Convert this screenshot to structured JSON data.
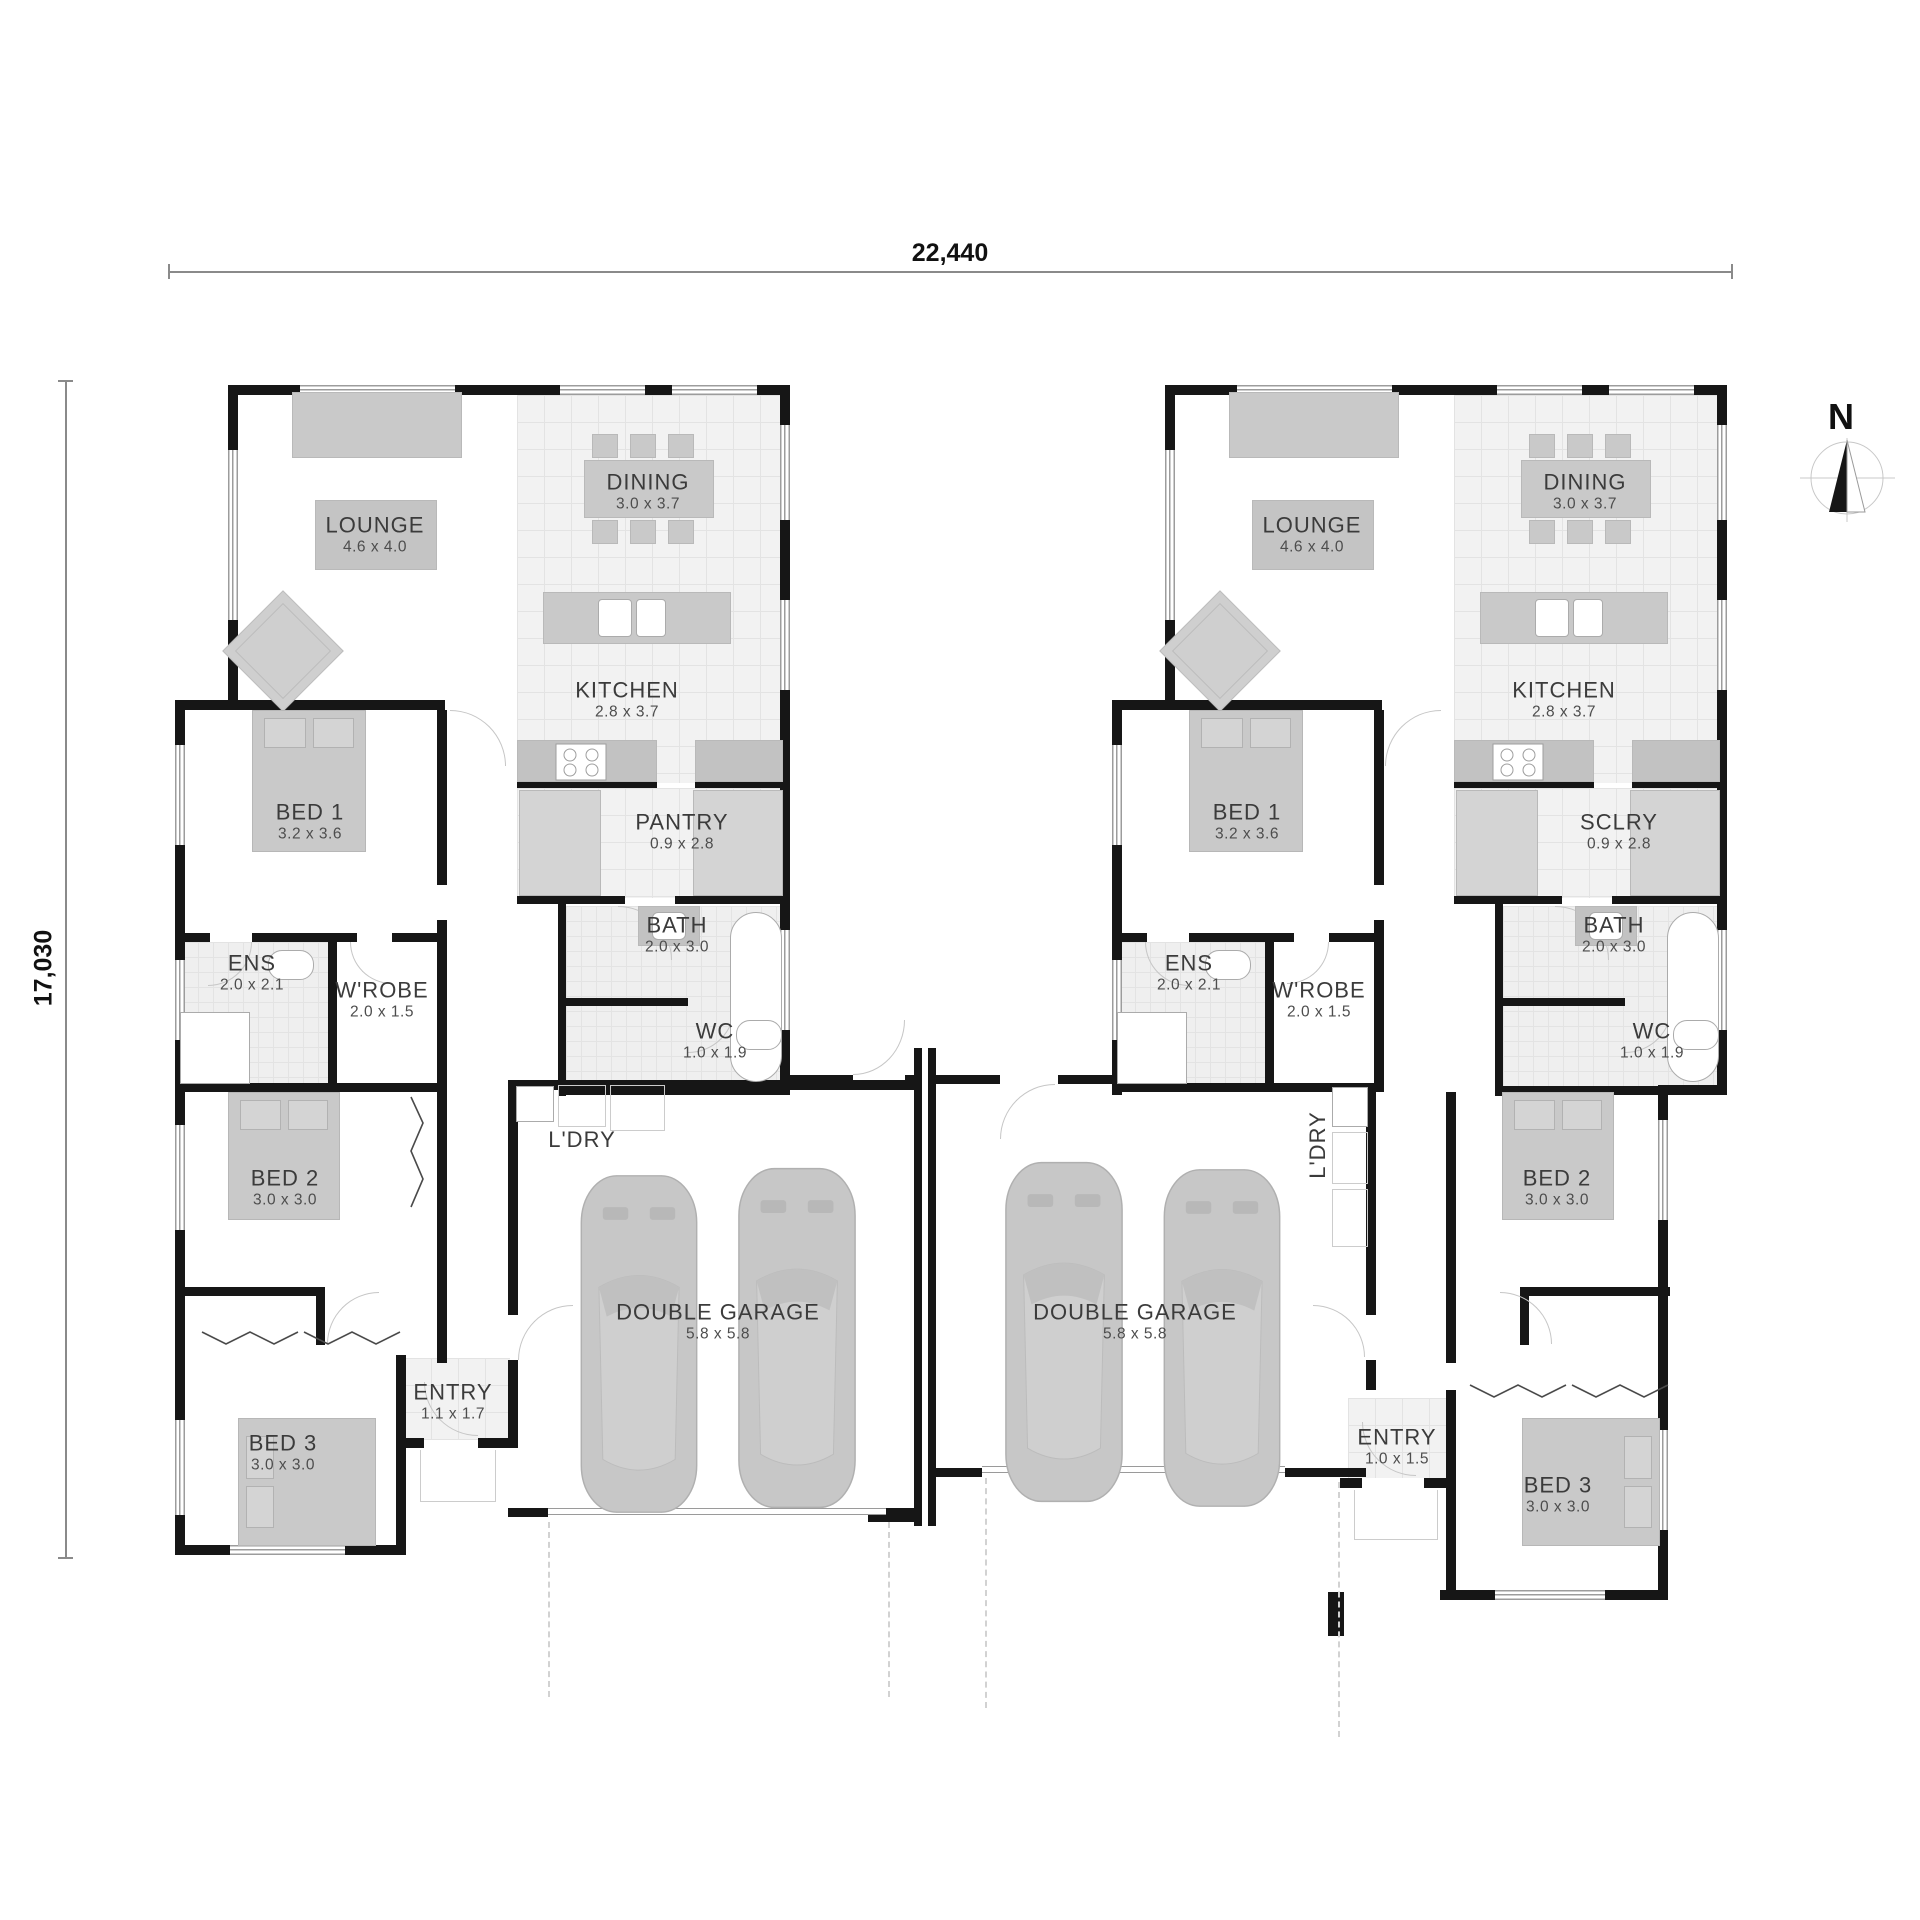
{
  "dimensions": {
    "width_label": "22,440",
    "height_label": "17,030"
  },
  "compass": {
    "label": "N"
  },
  "units": {
    "left": {
      "lounge": {
        "name": "LOUNGE",
        "size": "4.6 x 4.0"
      },
      "dining": {
        "name": "DINING",
        "size": "3.0 x 3.7"
      },
      "kitchen": {
        "name": "KITCHEN",
        "size": "2.8 x 3.7"
      },
      "bed1": {
        "name": "BED 1",
        "size": "3.2 x 3.6"
      },
      "pantry": {
        "name": "PANTRY",
        "size": "0.9 x 2.8"
      },
      "bath": {
        "name": "BATH",
        "size": "2.0 x 3.0"
      },
      "ens": {
        "name": "ENS",
        "size": "2.0 x 2.1"
      },
      "wrobe": {
        "name": "W'ROBE",
        "size": "2.0 x 1.5"
      },
      "wc": {
        "name": "WC",
        "size": "1.0 x 1.9"
      },
      "bed2": {
        "name": "BED 2",
        "size": "3.0 x 3.0"
      },
      "ldry": {
        "name": "L'DRY"
      },
      "garage": {
        "name": "DOUBLE GARAGE",
        "size": "5.8 x 5.8"
      },
      "entry": {
        "name": "ENTRY",
        "size": "1.1 x 1.7"
      },
      "bed3": {
        "name": "BED 3",
        "size": "3.0 x 3.0"
      }
    },
    "right": {
      "lounge": {
        "name": "LOUNGE",
        "size": "4.6 x 4.0"
      },
      "dining": {
        "name": "DINING",
        "size": "3.0 x 3.7"
      },
      "kitchen": {
        "name": "KITCHEN",
        "size": "2.8 x 3.7"
      },
      "bed1": {
        "name": "BED 1",
        "size": "3.2 x 3.6"
      },
      "sclry": {
        "name": "SCLRY",
        "size": "0.9 x 2.8"
      },
      "bath": {
        "name": "BATH",
        "size": "2.0 x 3.0"
      },
      "ens": {
        "name": "ENS",
        "size": "2.0 x 2.1"
      },
      "wrobe": {
        "name": "W'ROBE",
        "size": "2.0 x 1.5"
      },
      "wc": {
        "name": "WC",
        "size": "1.0 x 1.9"
      },
      "bed2": {
        "name": "BED 2",
        "size": "3.0 x 3.0"
      },
      "ldry": {
        "name": "L'DRY"
      },
      "garage": {
        "name": "DOUBLE GARAGE",
        "size": "5.8 x 5.8"
      },
      "entry": {
        "name": "ENTRY",
        "size": "1.0 x 1.5"
      },
      "bed3": {
        "name": "BED 3",
        "size": "3.0 x 3.0"
      }
    }
  }
}
